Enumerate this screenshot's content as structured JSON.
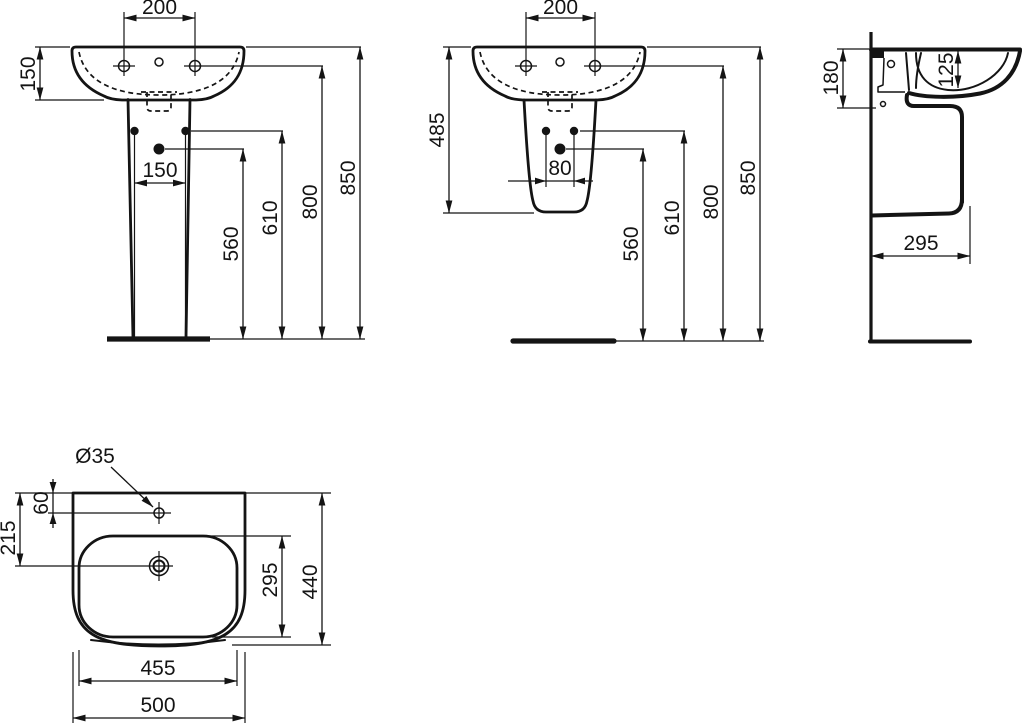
{
  "drawing": {
    "views": {
      "front_pedestal": {
        "dims": {
          "tap_spacing": "200",
          "rim_height": "150",
          "fixing_spacing": "150",
          "trap_height": "560",
          "fixing_height": "610",
          "tap_height": "800",
          "total_height": "850"
        }
      },
      "front_semi_pedestal": {
        "dims": {
          "tap_spacing": "200",
          "unit_height": "485",
          "fixing_spacing": "80",
          "trap_height": "560",
          "fixing_height": "610",
          "tap_height": "800",
          "total_height": "850"
        }
      },
      "side": {
        "dims": {
          "mounting_height": "180",
          "bowl_depth": "125",
          "basin_depth": "295"
        }
      },
      "plan": {
        "dims": {
          "tap_hole_diameter": "Ø35",
          "tap_hole_offset": "60",
          "drain_offset": "215",
          "bowl_length": "295",
          "overall_depth": "440",
          "bowl_width": "455",
          "overall_width": "500"
        }
      }
    },
    "line_color": "#141414",
    "background": "#ffffff"
  }
}
